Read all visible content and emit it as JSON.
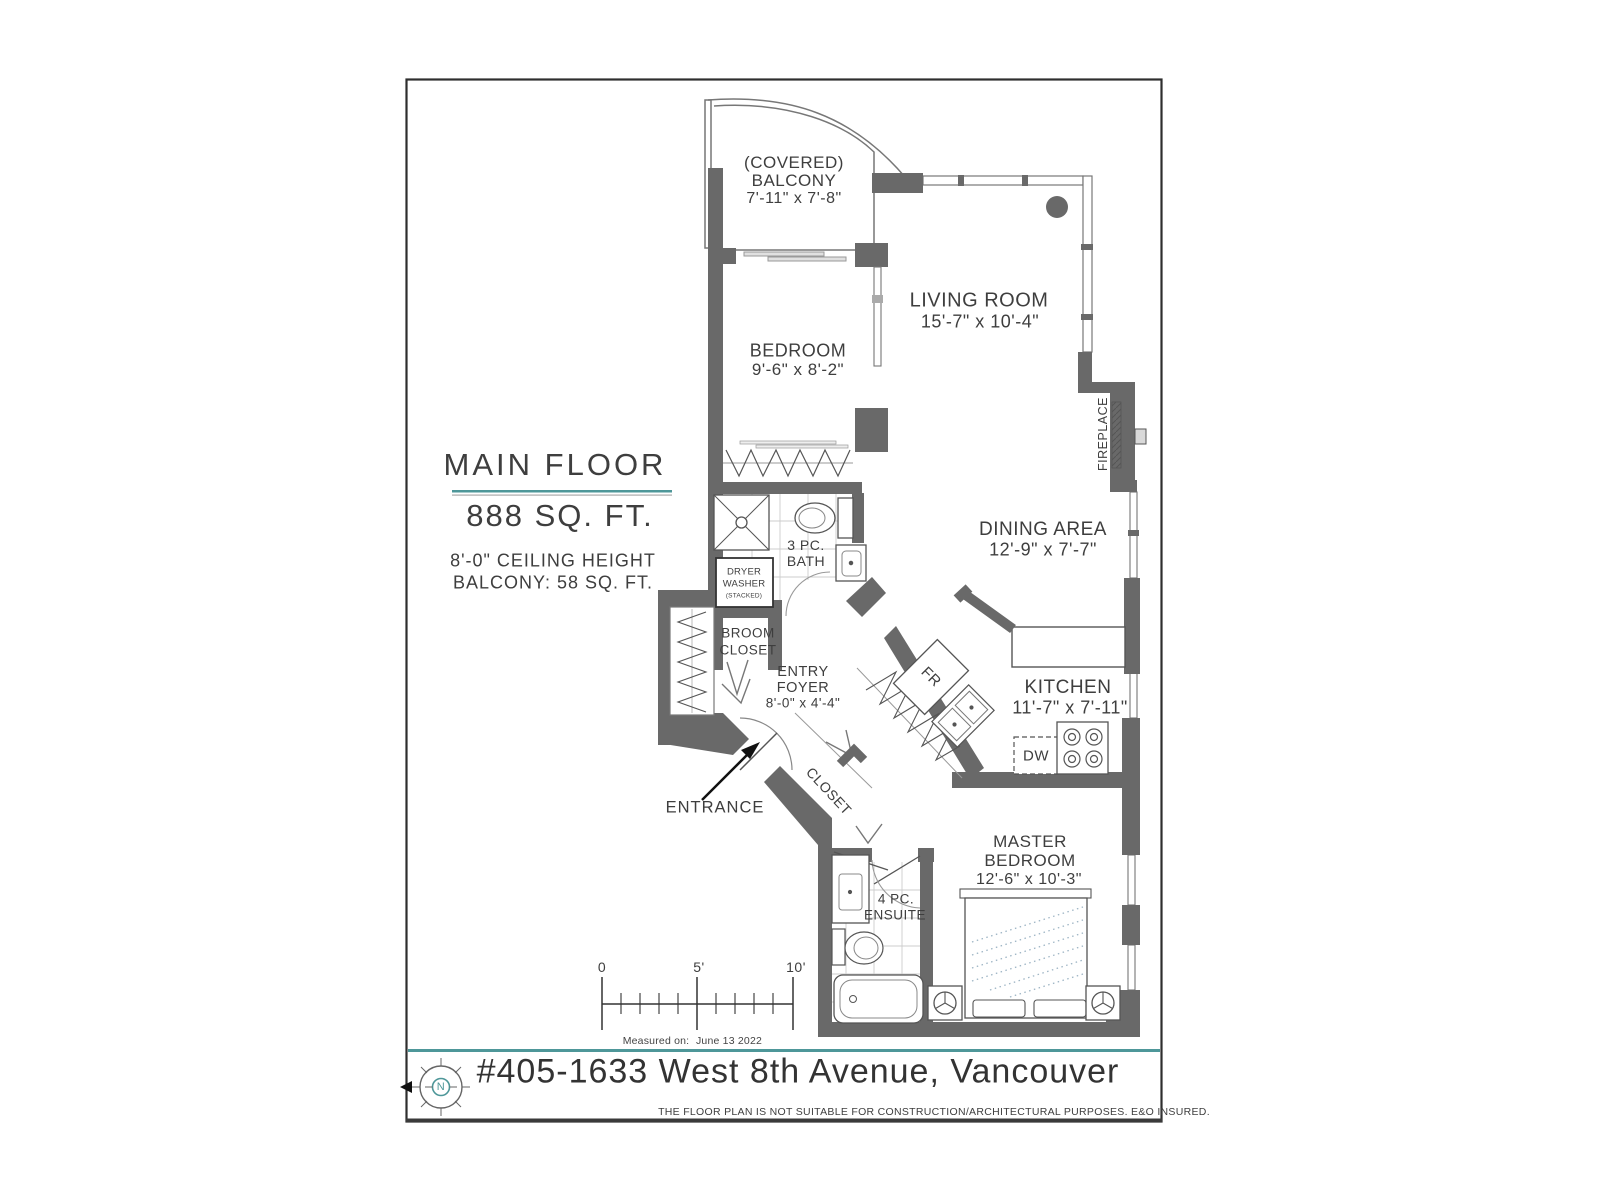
{
  "title_block": {
    "title": "MAIN FLOOR",
    "area": "888 SQ. FT.",
    "ceiling": "8'-0\" CEILING HEIGHT",
    "balcony_area": "BALCONY: 58 SQ. FT."
  },
  "rooms": {
    "balcony_l1": "(COVERED)",
    "balcony_l2": "BALCONY",
    "balcony_dims": "7'-11\" x 7'-8\"",
    "living_name": "LIVING ROOM",
    "living_dims": "15'-7\" x 10'-4\"",
    "bedroom_name": "BEDROOM",
    "bedroom_dims": "9'-6\" x 8'-2\"",
    "dining_name": "DINING AREA",
    "dining_dims": "12'-9\" x 7'-7\"",
    "kitchen_name": "KITCHEN",
    "kitchen_dims": "11'-7\" x 7'-11\"",
    "master_l1": "MASTER",
    "master_l2": "BEDROOM",
    "master_dims": "12'-6\" x 10'-3\"",
    "entry_l1": "ENTRY",
    "entry_l2": "FOYER",
    "entry_dims": "8'-0\" x 4'-4\"",
    "broom_l1": "BROOM",
    "broom_l2": "CLOSET",
    "bath_l1": "3 PC.",
    "bath_l2": "BATH",
    "ensuite_l1": "4 PC.",
    "ensuite_l2": "ENSUITE",
    "closet": "CLOSET",
    "entrance": "ENTRANCE",
    "fireplace": "FIREPLACE",
    "fr": "FR",
    "dw": "DW",
    "dryer": "DRYER",
    "washer": "WASHER",
    "stacked": "(STACKED)"
  },
  "scale_bar": {
    "zero": "0",
    "five": "5'",
    "ten": "10'",
    "measured_label": "Measured on:",
    "measured_date": "June 13  2022"
  },
  "footer": {
    "address": "#405-1633 West 8th Avenue, Vancouver",
    "disclaimer": "THE  FLOOR PLAN  IS NOT SUITABLE FOR CONSTRUCTION/ARCHITECTURAL PURPOSES.    E&O INSURED.",
    "compass_n": "N"
  },
  "colors": {
    "wall": "#696969",
    "teal": "#4e9799",
    "text": "#3e3e3e"
  }
}
